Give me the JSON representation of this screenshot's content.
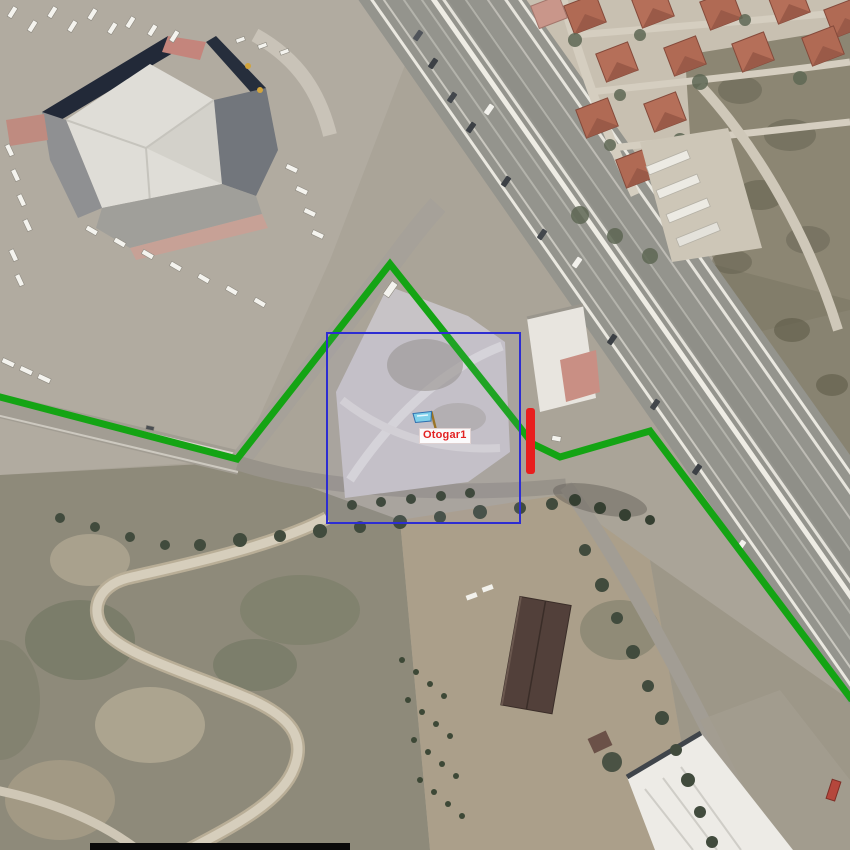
{
  "map": {
    "marker": {
      "label": "Otogar1",
      "label_color": "#e22222",
      "label_x": 419,
      "label_y": 428,
      "flag_color": "#7fd0ea",
      "pole_color": "#9a7426"
    },
    "route": {
      "color": "#14a414",
      "width": 7,
      "points": [
        [
          -4,
          396
        ],
        [
          237,
          459
        ],
        [
          390,
          264
        ],
        [
          533,
          444
        ],
        [
          560,
          457
        ],
        [
          650,
          431
        ],
        [
          852,
          700
        ]
      ]
    },
    "selection_rect": {
      "x": 327,
      "y": 333,
      "width": 193,
      "height": 190,
      "color": "#2d2dd2",
      "border_width": 2
    },
    "red_bar": {
      "x": 526,
      "y": 408,
      "width": 9,
      "height": 66,
      "color": "#e81e1e"
    }
  }
}
